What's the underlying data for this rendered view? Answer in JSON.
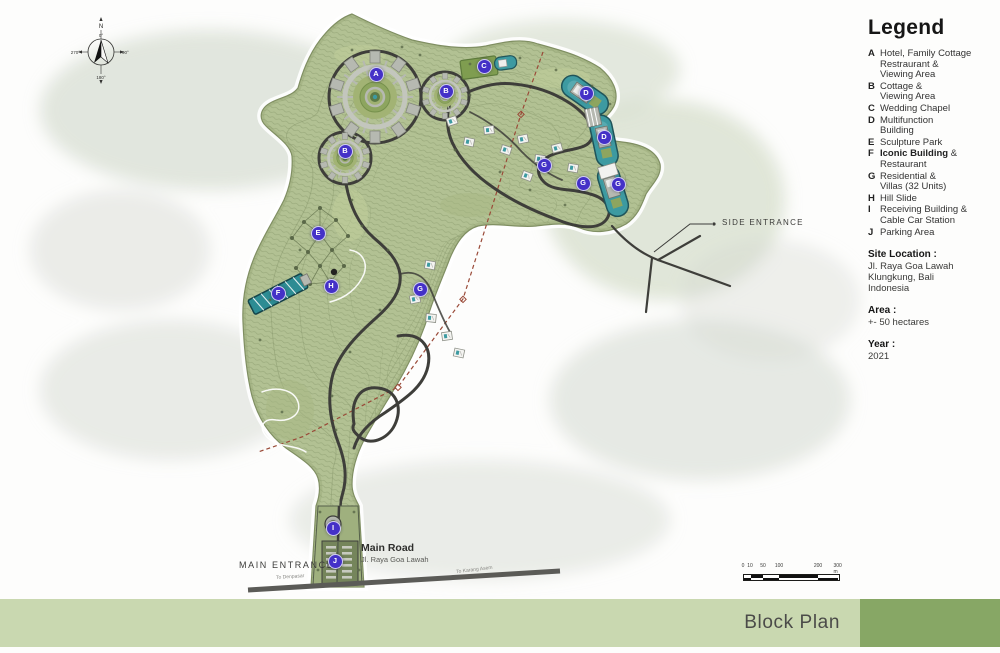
{
  "legend": {
    "title": "Legend",
    "items": [
      {
        "key": "A",
        "label": "Hotel, Family Cottage\nRestraurant &\nViewing Area"
      },
      {
        "key": "B",
        "label": "Cottage &\nViewing Area"
      },
      {
        "key": "C",
        "label": "Wedding Chapel"
      },
      {
        "key": "D",
        "label": "Multifunction\nBuilding"
      },
      {
        "key": "E",
        "label": "Sculpture Park"
      },
      {
        "key": "F",
        "label": "Iconic Building &\nRestaurant",
        "bold": "Iconic Building"
      },
      {
        "key": "G",
        "label": "Residential &\nVillas (32 Units)"
      },
      {
        "key": "H",
        "label": "Hill Slide"
      },
      {
        "key": "I",
        "label": "Receiving Building &\nCable Car Station"
      },
      {
        "key": "J",
        "label": "Parking Area"
      }
    ]
  },
  "info": {
    "site_location_label": "Site Location :",
    "site_location_value": "Jl. Raya Goa Lawah\nKlungkung, Bali\nIndonesia",
    "area_label": "Area :",
    "area_value": "+- 50 hectares",
    "year_label": "Year :",
    "year_value": "2021"
  },
  "map": {
    "labels": {
      "side_entrance": "SIDE ENTRANCE",
      "main_entrance": "MAIN ENTRANCE",
      "main_road_title": "Main Road",
      "main_road_sub": "Jl. Raya Goa Lawah",
      "to_left": "To Denpasar",
      "to_right": "To Karang Asem"
    },
    "compass": {
      "n": "N",
      "deg0": "0°",
      "deg90": "90°",
      "deg180": "180°",
      "deg270": "270°"
    },
    "scalebar": {
      "ticks": [
        {
          "label": "0",
          "x": 5
        },
        {
          "label": "10",
          "x": 12
        },
        {
          "label": "50",
          "x": 25
        },
        {
          "label": "100",
          "x": 41
        },
        {
          "label": "200",
          "x": 80
        },
        {
          "label": "300 m",
          "x": 101
        }
      ]
    },
    "markers": [
      {
        "letter": "A",
        "x": 375,
        "y": 73
      },
      {
        "letter": "B",
        "x": 445,
        "y": 90
      },
      {
        "letter": "C",
        "x": 483,
        "y": 65
      },
      {
        "letter": "D",
        "x": 585,
        "y": 92
      },
      {
        "letter": "D",
        "x": 603,
        "y": 136
      },
      {
        "letter": "B",
        "x": 344,
        "y": 150
      },
      {
        "letter": "G",
        "x": 543,
        "y": 164
      },
      {
        "letter": "G",
        "x": 582,
        "y": 182
      },
      {
        "letter": "G",
        "x": 617,
        "y": 183
      },
      {
        "letter": "E",
        "x": 317,
        "y": 232
      },
      {
        "letter": "F",
        "x": 277,
        "y": 292
      },
      {
        "letter": "H",
        "x": 330,
        "y": 285
      },
      {
        "letter": "G",
        "x": 419,
        "y": 288
      },
      {
        "letter": "I",
        "x": 332,
        "y": 527
      },
      {
        "letter": "J",
        "x": 334,
        "y": 560
      }
    ]
  },
  "footer": {
    "title": "Block Plan"
  },
  "colors": {
    "marker": "#4431c7",
    "site_green": "#b2c193",
    "road_dark": "#3e3e3a",
    "water_teal": "#3d9aa1",
    "footer_light": "#c9d8b0",
    "footer_dark": "#87a765"
  }
}
